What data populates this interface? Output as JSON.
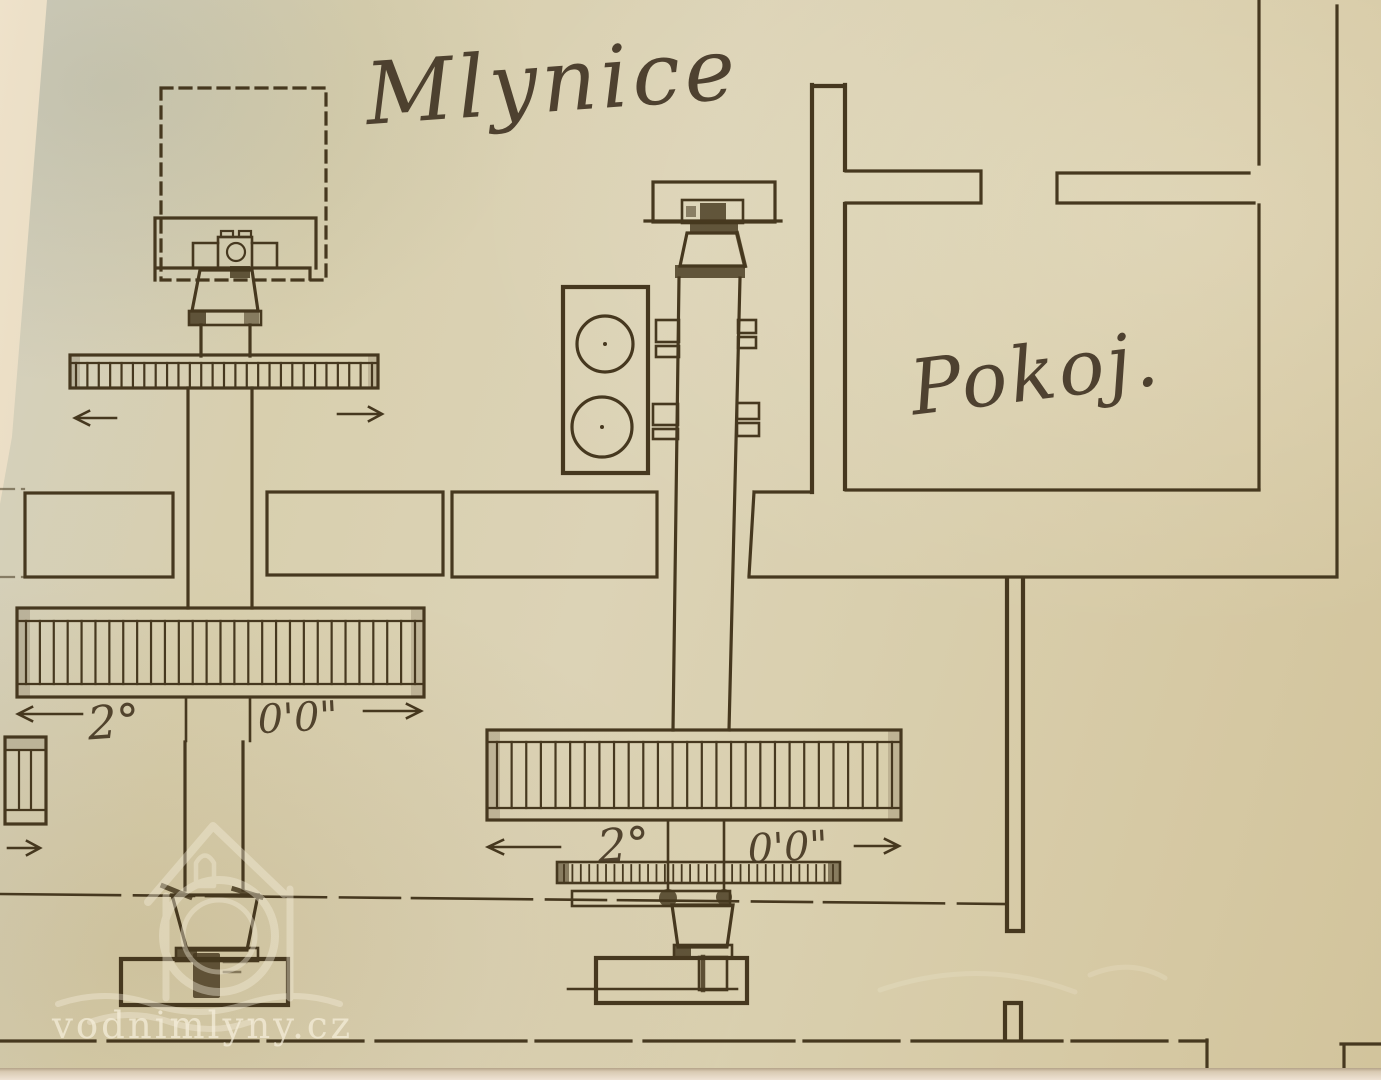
{
  "titles": {
    "mill_room": "Mlynice",
    "room": "Pokoj."
  },
  "dimensions": {
    "left_gear": {
      "primary": "2°",
      "secondary": "0'0\""
    },
    "center_gear": {
      "primary": "2°",
      "secondary": "0'0\""
    }
  },
  "watermark": {
    "site": "vodnimlyny.cz"
  },
  "colors": {
    "paper": "#d8cfae",
    "ink": "#46381f",
    "watermark_text": "#f5eedb"
  }
}
